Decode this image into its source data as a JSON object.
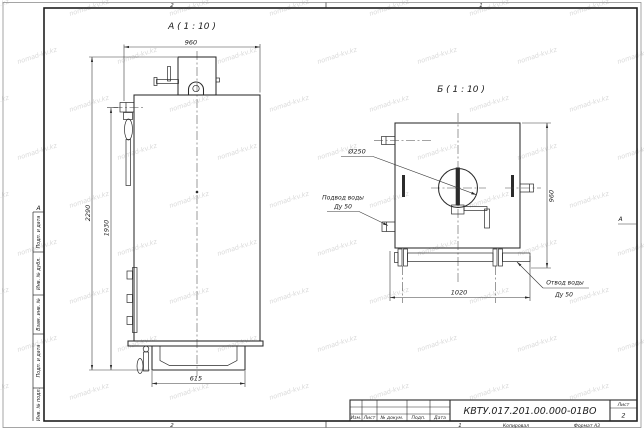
{
  "watermark": {
    "text": "nomad-kv.kz"
  },
  "frame": {
    "zone_top_left": "2",
    "zone_top_right": "1",
    "zone_bottom_left": "2",
    "zone_bottom_right": "1",
    "zone_left": "А",
    "zone_right": "А",
    "strip_labels": [
      "Подп. и дата",
      "Инв. № дубл.",
      "Взам. инв. №",
      "Подп. и дата",
      "Инв. № подл."
    ]
  },
  "views": {
    "a": {
      "label": "А ( 1 : 10 )",
      "dim_width": "960",
      "dim_total_height": "2290",
      "dim_outlet_height": "1930",
      "dim_base_width": "615"
    },
    "b": {
      "label": "Б ( 1 : 10 )",
      "dim_depth": "960",
      "dim_bar_length": "1020",
      "chimney_diameter": "Ø250",
      "water_inlet_line1": "Подвод воды",
      "water_inlet_line2": "Ду 50",
      "water_outlet_line1": "Отвод воды",
      "water_outlet_line2": "Ду 50"
    }
  },
  "title_block": {
    "doc_number": "КВТУ.017.201.00.000-01ВО",
    "columns": [
      "Изм.",
      "Лист",
      "№ докум.",
      "Подп.",
      "Дата"
    ],
    "sheet_label": "Лист",
    "sheet_number": "2",
    "footer_copied": "Копировал",
    "footer_format": "Формат А3"
  }
}
